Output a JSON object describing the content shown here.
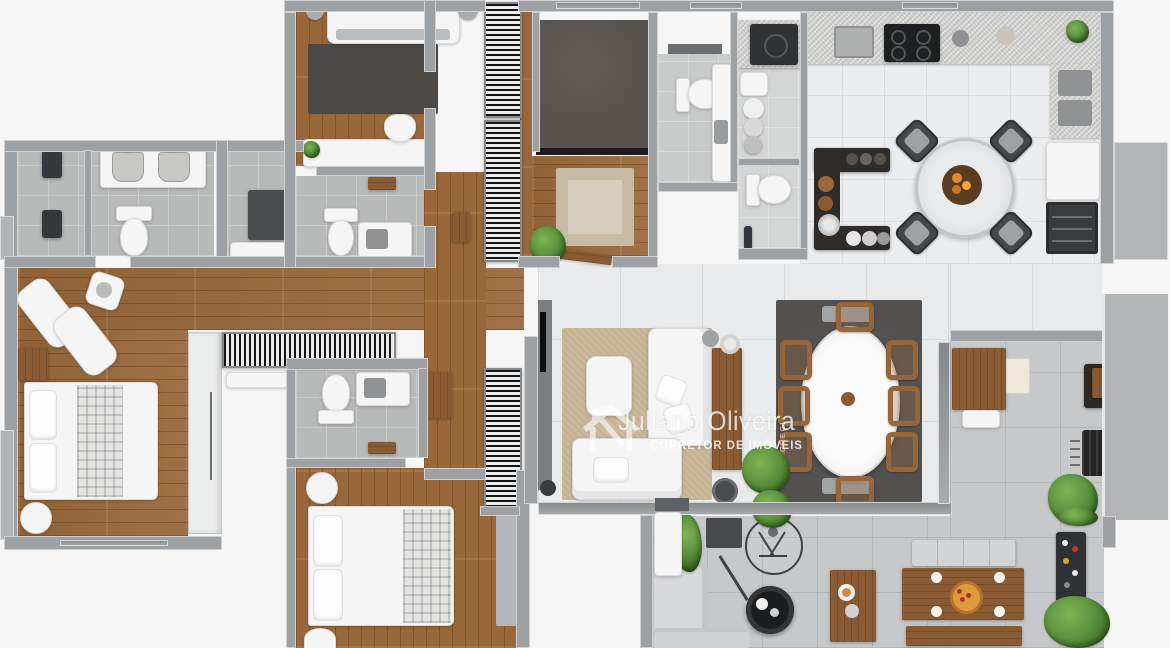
{
  "watermark": {
    "icon": "house-arrow-icon",
    "name": "Juliano Oliveira",
    "subtitle": "CORRETOR DE IMÓVEIS",
    "license_vertical": "CRECI"
  },
  "palette": {
    "background": "#f6f6f6",
    "wall_gray": "#9ea1a3",
    "wood_floor": "#9b6a3c",
    "bath_tile": "#b8b9b9",
    "kitchen_tile": "#ebecee",
    "living_tile": "#e9eaeb",
    "terrace_tile": "#c7c8c9",
    "dining_rug": "#53514f",
    "sofa_rug": "#cbb99c",
    "entry_rug": "#c6baa5",
    "bedroom_rug": "#4b4846",
    "plant_green": "#4e8a33",
    "furniture_wood": "#8a5a33",
    "dark_counter": "#2f2b28",
    "white_furniture": "#f4f5f4",
    "pizza_orange": "#e09a3e",
    "watermark_white": "#ffffff"
  },
  "rooms": [
    {
      "name": "master-bathroom",
      "floor": "stone-tile"
    },
    {
      "name": "master-closet",
      "floor": "stone-tile"
    },
    {
      "name": "master-bedroom",
      "floor": "wood"
    },
    {
      "name": "bedroom-2",
      "floor": "wood"
    },
    {
      "name": "bathroom-2",
      "floor": "stone-tile"
    },
    {
      "name": "bedroom-3",
      "floor": "wood"
    },
    {
      "name": "bathroom-3",
      "floor": "stone-tile"
    },
    {
      "name": "hallway",
      "floor": "wood"
    },
    {
      "name": "den",
      "floor": "dark-carpet"
    },
    {
      "name": "entry-hall",
      "floor": "wood"
    },
    {
      "name": "guest-wc",
      "floor": "tile"
    },
    {
      "name": "laundry",
      "floor": "tile"
    },
    {
      "name": "kitchen",
      "floor": "white-tile"
    },
    {
      "name": "living-room",
      "floor": "large-tile"
    },
    {
      "name": "dining-area",
      "floor": "large-tile"
    },
    {
      "name": "gourmet-terrace",
      "floor": "gray-tile"
    }
  ],
  "furniture_inventory": [
    "double-bed-master",
    "double-bed-2",
    "double-bed-3",
    "chaise-lounges",
    "double-vanity",
    "toilets",
    "showers",
    "striped-wardrobes",
    "desk-with-chair",
    "washer",
    "laundry-baskets",
    "cooktop",
    "kitchen-sink",
    "round-breakfast-table-4-chairs",
    "dark-bar-island",
    "wine-cabinet",
    "oval-dining-table-8-chairs",
    "l-shaped-sofa",
    "armchair",
    "tv-panel",
    "console-table",
    "hanging-cocoon-chair",
    "fire-pit-table",
    "outdoor-dining-table-pizza",
    "outdoor-benches",
    "grill",
    "bar-cart",
    "plants"
  ]
}
